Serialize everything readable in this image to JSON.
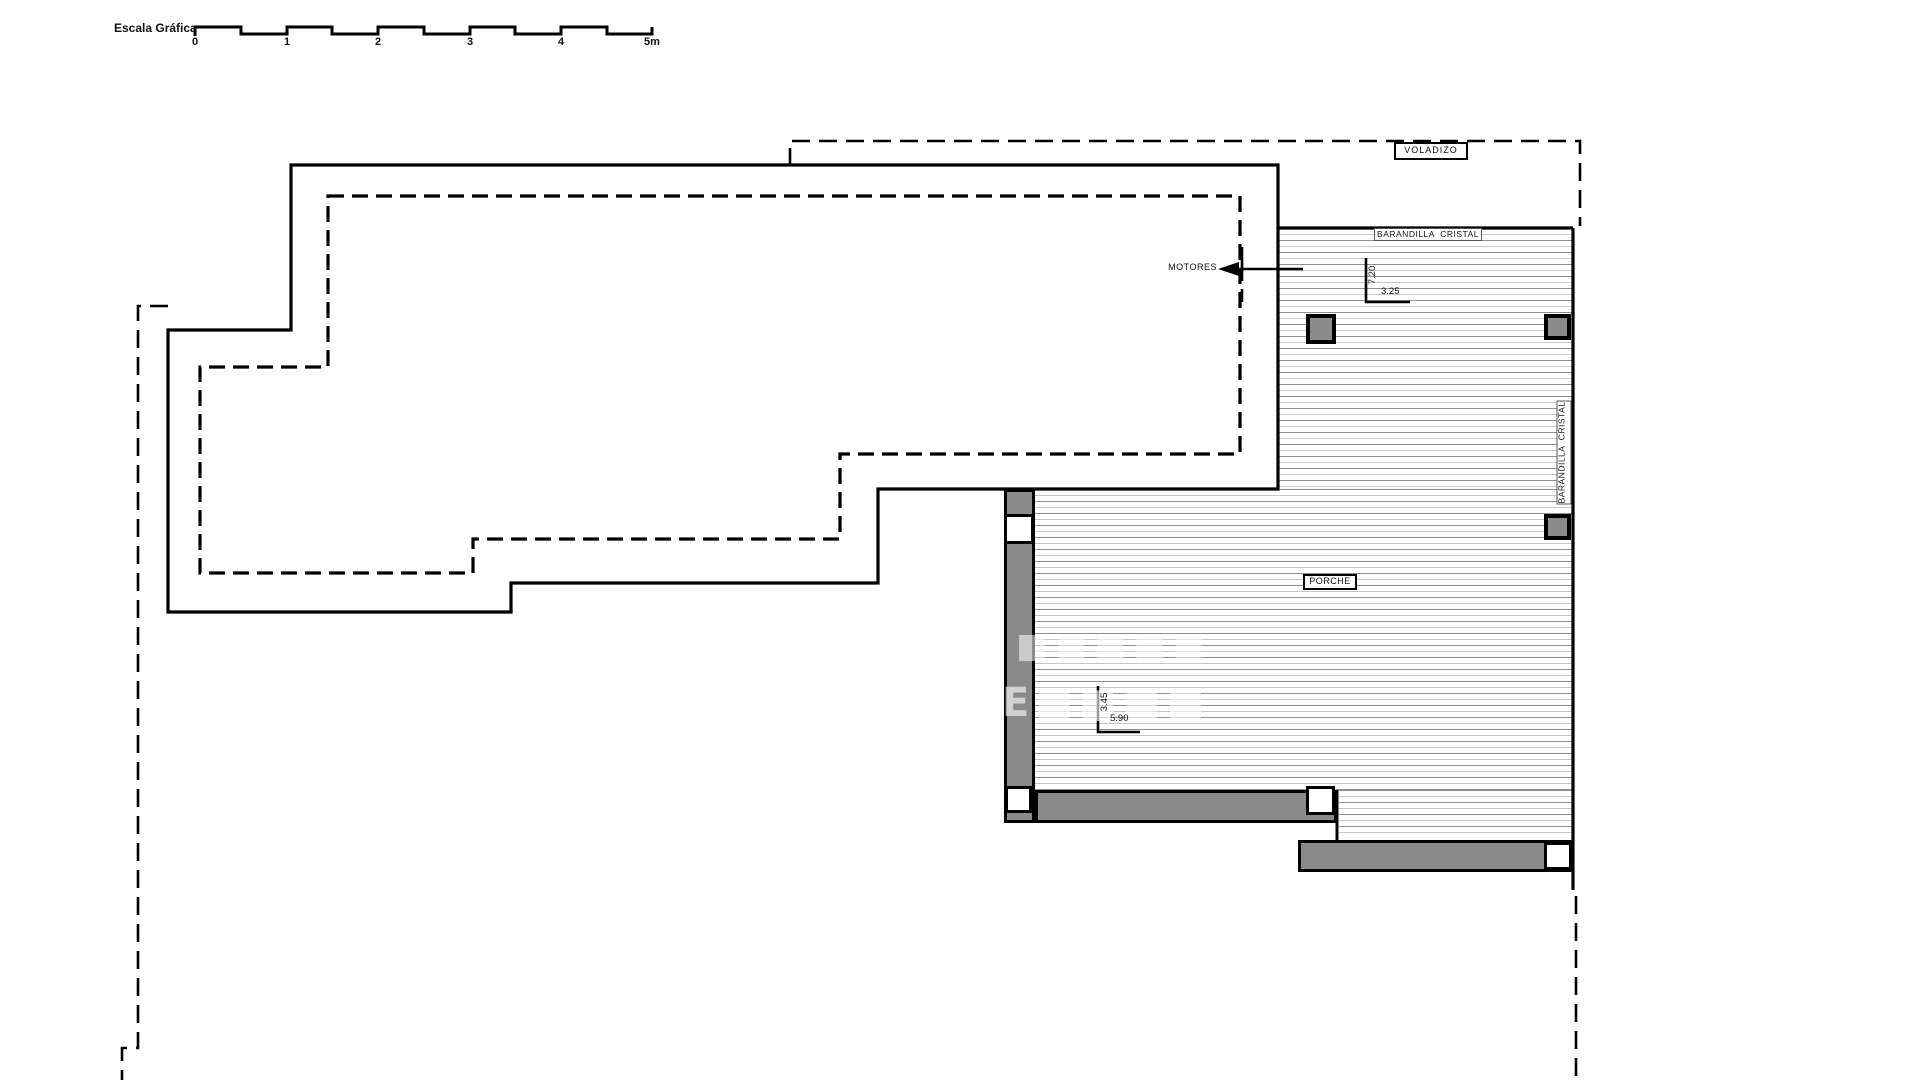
{
  "scale_bar": {
    "label": "Escala Gráfica",
    "ticks": [
      "0",
      "1",
      "2",
      "3",
      "4",
      "5m"
    ]
  },
  "plan": {
    "labels": {
      "voladizo": "VOLADIZO",
      "barandilla_top": "BARANDILLA  CRISTAL",
      "barandilla_right": "BARANDILLA  CRISTAL",
      "porche": "PORCHE",
      "motores": "MOTORES"
    },
    "dimensions": {
      "dim1_vertical": "7.20",
      "dim1_horizontal": "3.25",
      "dim2_vertical": "3.45",
      "dim2_horizontal": "5.90"
    },
    "watermark": {
      "line1": "■■■■■",
      "line2": "E■■■■"
    },
    "colors": {
      "line": "#000000",
      "wall_fill": "#8a8a8a",
      "hatch_dark": "#8f8f8f",
      "hatch_light": "#c6c6c6",
      "background": "#ffffff"
    }
  }
}
